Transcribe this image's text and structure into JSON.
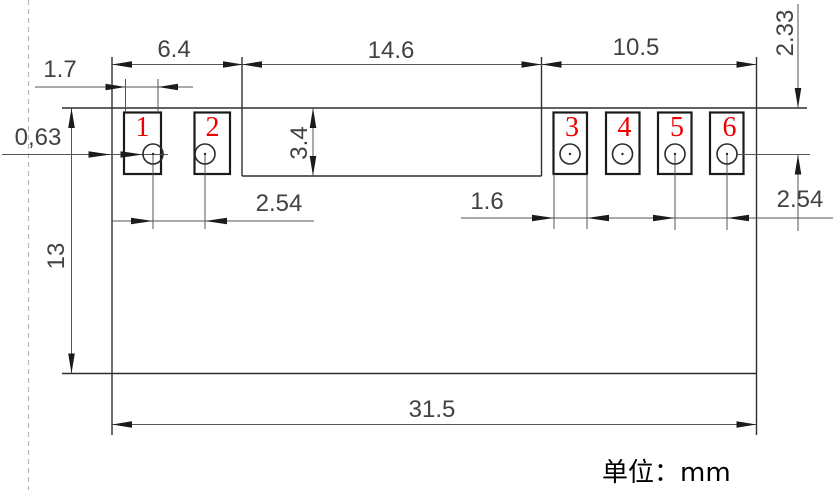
{
  "drawing": {
    "title_note": "单位：mm",
    "pad_labels": [
      "1",
      "2",
      "3",
      "4",
      "5",
      "6"
    ],
    "dims": {
      "left_group_width": "6.4",
      "center_gap_width": "14.6",
      "right_group_width": "10.5",
      "pad1_width": "1.7",
      "edge_offset": "0,63",
      "body_height": "13",
      "pad_row_depth": "3.4",
      "left_hole_pitch": "2.54",
      "pad3_width": "1.6",
      "right_hole_pitch": "2.54",
      "edge_to_hole_center": "2.33",
      "total_width": "31.5"
    },
    "colors": {
      "pad_number_red": "#ee0000",
      "line_dark": "#1b1b1b",
      "dim_gray": "#565656"
    }
  }
}
